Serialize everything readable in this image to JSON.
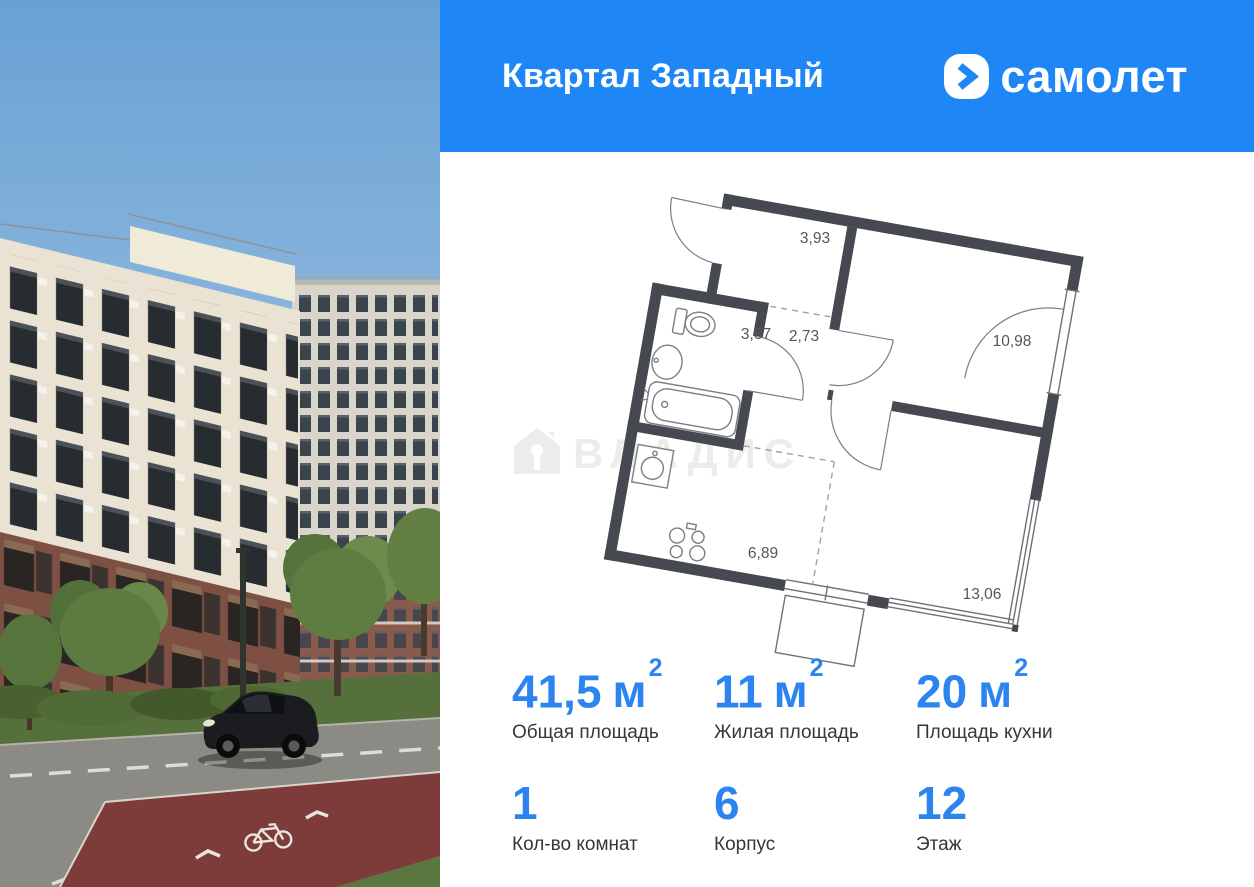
{
  "header": {
    "project_title": "Квартал Западный",
    "brand_name": "самолет"
  },
  "watermark": {
    "text": "ВЛАДИС"
  },
  "plan": {
    "rooms": [
      {
        "name": "hallway",
        "area": "3,93"
      },
      {
        "name": "bathroom",
        "area": "3,87"
      },
      {
        "name": "corridor",
        "area": "2,73"
      },
      {
        "name": "bedroom",
        "area": "10,98"
      },
      {
        "name": "kitchen",
        "area": "6,89"
      },
      {
        "name": "living-room",
        "area": "13,06"
      }
    ]
  },
  "stats": {
    "row1": [
      {
        "value": "41,5",
        "unit": "м",
        "sup": "2",
        "label": "Общая площадь"
      },
      {
        "value": "11",
        "unit": "м",
        "sup": "2",
        "label": "Жилая площадь"
      },
      {
        "value": "20",
        "unit": "м",
        "sup": "2",
        "label": "Площадь кухни"
      }
    ],
    "row2": [
      {
        "value": "1",
        "label": "Кол-во комнат"
      },
      {
        "value": "6",
        "label": "Корпус"
      },
      {
        "value": "12",
        "label": "Этаж"
      }
    ]
  },
  "colors": {
    "brand_blue": "#1f87f5",
    "stat_blue": "#2b84f0",
    "plan_wall": "#474950",
    "watermark_gray": "#ececec"
  }
}
